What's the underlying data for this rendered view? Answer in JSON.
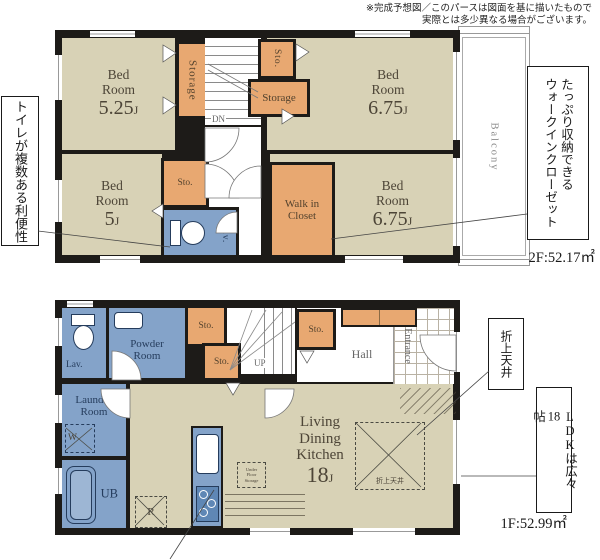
{
  "meta": {
    "disclaimer_line1": "※完成予想図／このパースは図面を基に描いたもので",
    "disclaimer_line2": "実際とは多少異なる場合がございます。"
  },
  "palette": {
    "room_beige": "#d8d2b6",
    "storage_orange": "#e8a871",
    "water_blue": "#84a3c9",
    "wall_black": "#1d1b18",
    "label_brown": "#4d4537"
  },
  "floor2": {
    "area": "2F:52.17㎡",
    "bedroom_tl": {
      "l1": "Bed",
      "l2": "Room",
      "num": "5.25",
      "unit": "J"
    },
    "bedroom_tr": {
      "l1": "Bed",
      "l2": "Room",
      "num": "6.75",
      "unit": "J"
    },
    "bedroom_bl": {
      "l1": "Bed",
      "l2": "Room",
      "num": "5",
      "unit": "J"
    },
    "bedroom_br": {
      "l1": "Bed",
      "l2": "Room",
      "num": "6.75",
      "unit": "J"
    },
    "storage_vertical": "Storage",
    "sto_small": "Sto.",
    "storage_h": "Storage",
    "sto": "Sto.",
    "lav": "Lav.",
    "wic_l1": "Walk in",
    "wic_l2": "Closet",
    "hall": "Hall",
    "dn": "DN",
    "balcony": "Balcony"
  },
  "floor1": {
    "area": "1F:52.99㎡",
    "lav": "Lav.",
    "powder_l1": "Powder",
    "powder_l2": "Room",
    "sto_a": "Sto.",
    "sto_b": "Sto.",
    "sto_c": "Sto.",
    "up": "UP",
    "hall": "Hall",
    "entrance": "Entrance",
    "laundry_l1": "Laundry",
    "laundry_l2": "Room",
    "washer": "W",
    "ub": "UB",
    "fridge": "R",
    "ufs_l1": "Under",
    "ufs_l2": "Floor",
    "ufs_l3": "Storage",
    "ldk": {
      "l1": "Living",
      "l2": "Dining",
      "l3": "Kitchen",
      "num": "18",
      "unit": "J"
    },
    "ceiling_box": "折上天井"
  },
  "callouts": {
    "toilet": "トイレが複数ある利便性",
    "wic_line1": "たっぷり収納できる",
    "wic_line2": "ウォークインクローゼット",
    "ceiling": "折上天井",
    "ldk_pre": "LDKは広々",
    "ldk_num": "18",
    "ldk_post": "帖"
  }
}
